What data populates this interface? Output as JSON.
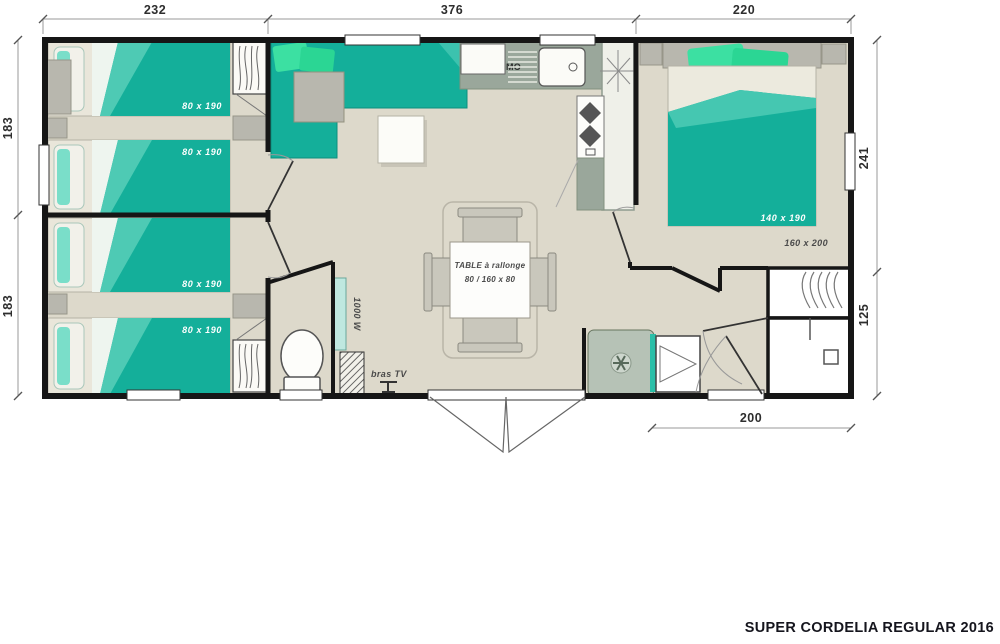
{
  "footer": {
    "title": "SUPER CORDELIA REGULAR 2016"
  },
  "colors": {
    "accent_teal": "#14af9a",
    "pillow_green": "#3ce0a2",
    "wall": "#161616",
    "floor": "#ddd9cb"
  },
  "plan": {
    "dims": {
      "top_left": "232",
      "top_mid": "376",
      "top_right": "220",
      "left_upper": "183",
      "left_lower": "183",
      "right_upper": "241",
      "right_lower": "125",
      "bottom": "200"
    },
    "labels": {
      "bed1a": "80 x 190",
      "bed1b": "80 x 190",
      "bed2a": "80 x 190",
      "bed2b": "80 x 190",
      "master_bed": "140 x 190",
      "master_frame": "160 x 200",
      "microwave": "MO",
      "table_line1": "TABLE à rallonge",
      "table_line2": "80 / 160 x 80",
      "heater": "1000 W",
      "tv_bracket": "bras TV"
    }
  }
}
